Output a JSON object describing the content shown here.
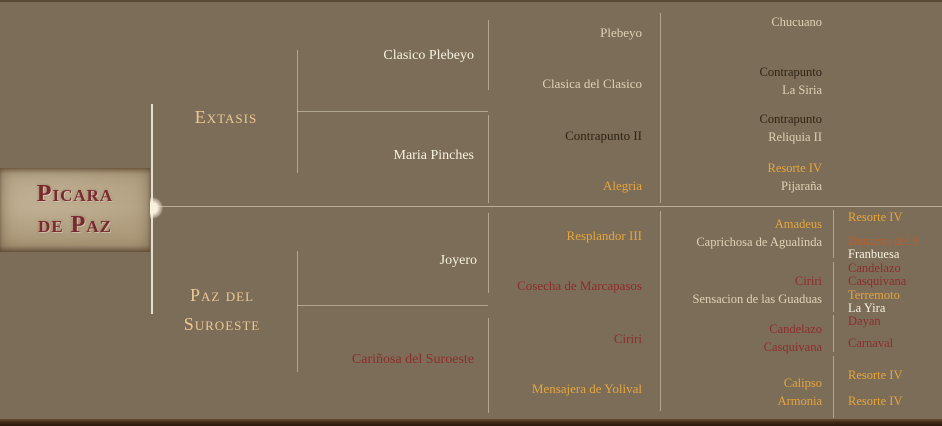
{
  "plate": {
    "line1": "Picara",
    "line2": "de Paz"
  },
  "palette": {
    "background": "#7c6d58",
    "plate_fill": "#b2a082",
    "plate_text_red": "#7b2931",
    "line": "#ece4ce",
    "white_name": "#f6f1e1",
    "cream_name": "#ddd2b6",
    "gold_name": "#e6a53c",
    "header_gold": "#ecc893",
    "dark_red_name": "#8e2c2e",
    "dark_brown_name": "#2f2316",
    "orange_name": "#bd5c25"
  },
  "pedigree": {
    "gen2": {
      "sire": {
        "name": "Extasis",
        "color": "header-gold"
      },
      "dam": {
        "line1": "Paz del",
        "line2": "Suroeste",
        "color": "header-gold"
      }
    },
    "gen3": [
      {
        "name": "Clasico Plebeyo",
        "color": "white"
      },
      {
        "name": "Maria Pinches",
        "color": "white"
      },
      {
        "name": "Joyero",
        "color": "white"
      },
      {
        "name": "Cariñosa del Suroeste",
        "color": "red"
      }
    ],
    "gen4": [
      {
        "name": "Plebeyo",
        "color": "cream"
      },
      {
        "name": "Clasica del Clasico",
        "color": "cream"
      },
      {
        "name": "Contrapunto II",
        "color": "dark"
      },
      {
        "name": "Alegria",
        "color": "gold"
      },
      {
        "name": "Resplandor III",
        "color": "gold"
      },
      {
        "name": "Cosecha de Marcapasos",
        "color": "red"
      },
      {
        "name": "Ciriri",
        "color": "red"
      },
      {
        "name": "Mensajera de Yolival",
        "color": "gold"
      }
    ],
    "gen5": [
      {
        "lines": [
          {
            "name": "Chucuano",
            "color": "cream"
          }
        ]
      },
      {
        "lines": [
          {
            "name": "Contrapunto",
            "color": "dark"
          },
          {
            "name": "La Siria",
            "color": "cream"
          }
        ]
      },
      {
        "lines": [
          {
            "name": "Contrapunto",
            "color": "dark"
          },
          {
            "name": "Reliquia II",
            "color": "cream"
          }
        ]
      },
      {
        "lines": [
          {
            "name": "Resorte IV",
            "color": "gold"
          },
          {
            "name": "Pijaraña",
            "color": "cream"
          }
        ]
      },
      {
        "lines": [
          {
            "name": "Amadeus",
            "color": "gold"
          },
          {
            "name": "Caprichosa de Agualinda",
            "color": "cream"
          }
        ]
      },
      {
        "lines": [
          {
            "name": "Ciriri",
            "color": "red"
          },
          {
            "name": "Sensacion de las Guaduas",
            "color": "cream"
          }
        ]
      },
      {
        "lines": [
          {
            "name": "Candelazo",
            "color": "red"
          },
          {
            "name": "Casquivana",
            "color": "red"
          }
        ]
      },
      {
        "lines": [
          {
            "name": "Calipso",
            "color": "gold"
          },
          {
            "name": "Armonia",
            "color": "gold"
          }
        ]
      }
    ],
    "gen6": [
      {
        "name": "Resorte IV",
        "color": "gold"
      },
      {
        "name": "Durazno del 8",
        "color": "orange"
      },
      {
        "name": "Franbuesa",
        "color": "white"
      },
      {
        "name": "Candelazo",
        "color": "red"
      },
      {
        "name": "Casquivana",
        "color": "red"
      },
      {
        "name": "Terremoto",
        "color": "gold"
      },
      {
        "name": "La Yira",
        "color": "white"
      },
      {
        "name": "Dayan",
        "color": "red"
      },
      {
        "name": "Carnaval",
        "color": "red"
      },
      {
        "name": "Resorte IV",
        "color": "gold"
      },
      {
        "name": "Resorte IV",
        "color": "gold"
      }
    ]
  }
}
